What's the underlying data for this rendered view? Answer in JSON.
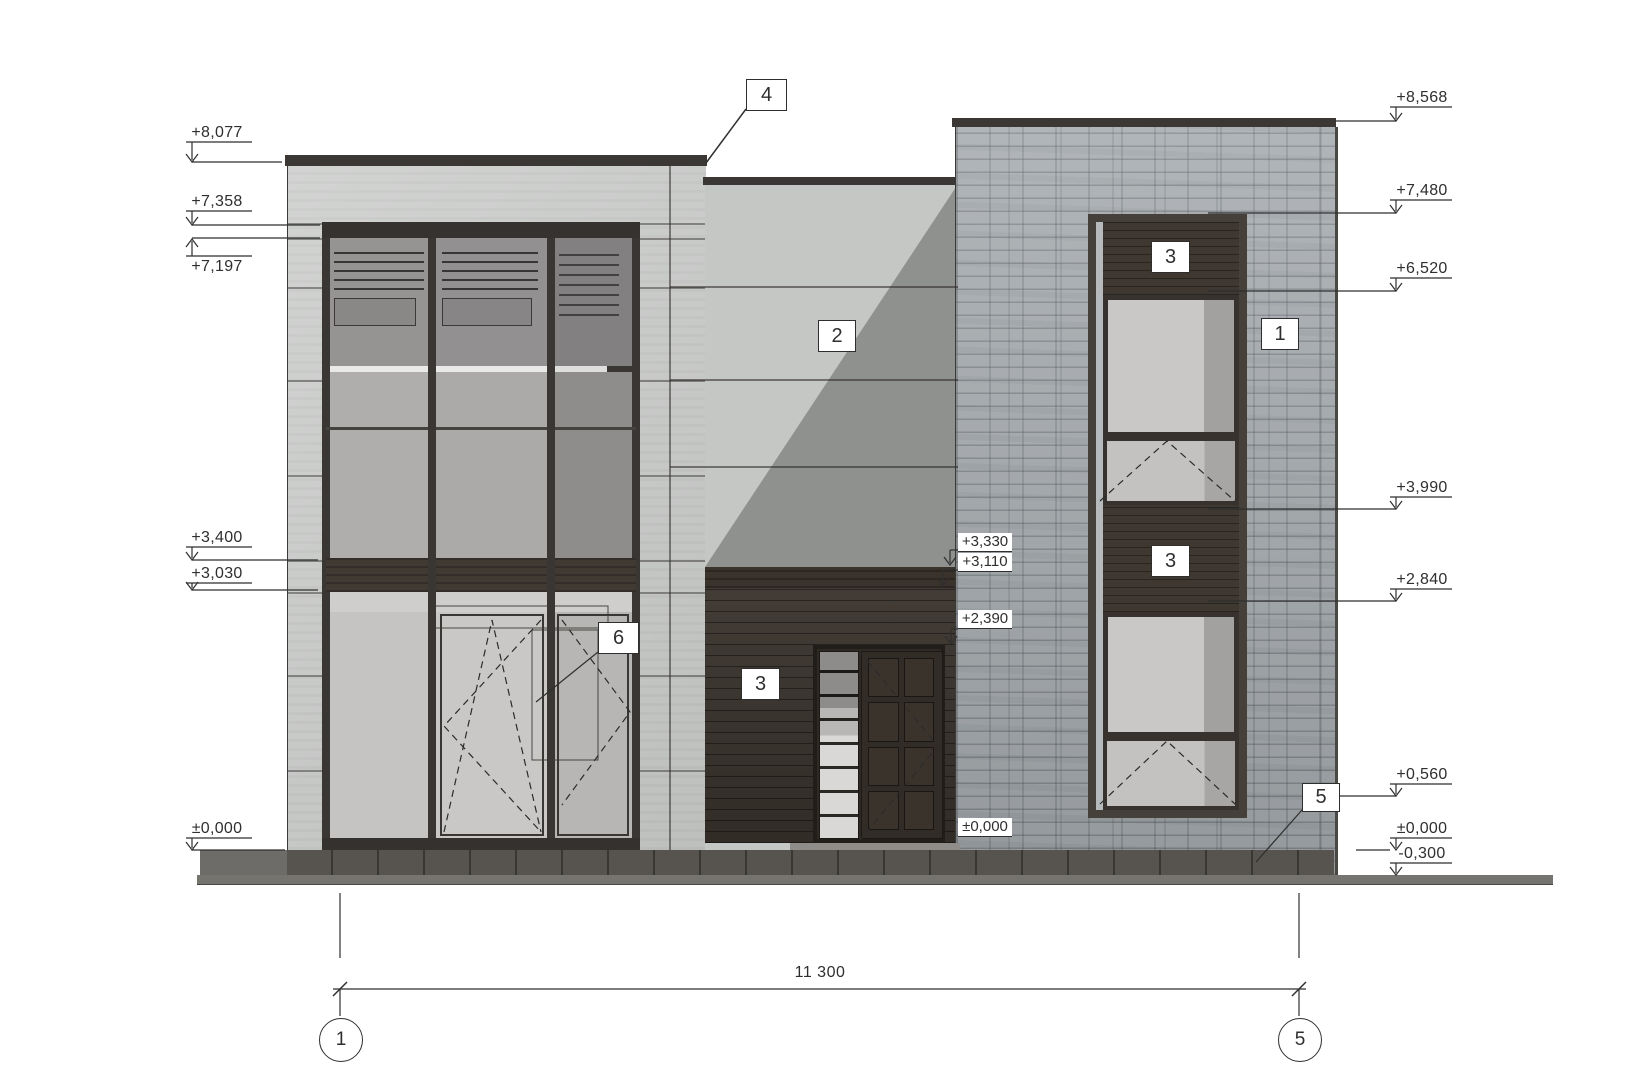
{
  "levels": {
    "left": [
      "+8,077",
      "+7,358",
      "+7,197",
      "+3,400",
      "+3,030",
      "±0,000"
    ],
    "right": [
      "+8,568",
      "+7,480",
      "+6,520",
      "+3,990",
      "+2,840",
      "+0,560",
      "±0,000",
      "-0,300"
    ],
    "mid": [
      "+3,330",
      "+3,110",
      "+2,390",
      "±0,000"
    ]
  },
  "callouts": {
    "roof": "4",
    "wall": "2",
    "stone": "1",
    "niche_top": "3",
    "niche_mid": "3",
    "entrance": "3",
    "window": "6",
    "plinth": "5"
  },
  "axes": {
    "start": "1",
    "end": "5"
  },
  "dimension": {
    "overall": "11 300"
  },
  "colors": {
    "stone": "#a6abaf",
    "wood": "#38322b",
    "plaster": "#c8cac8",
    "annotation": "#2f2f2f"
  }
}
